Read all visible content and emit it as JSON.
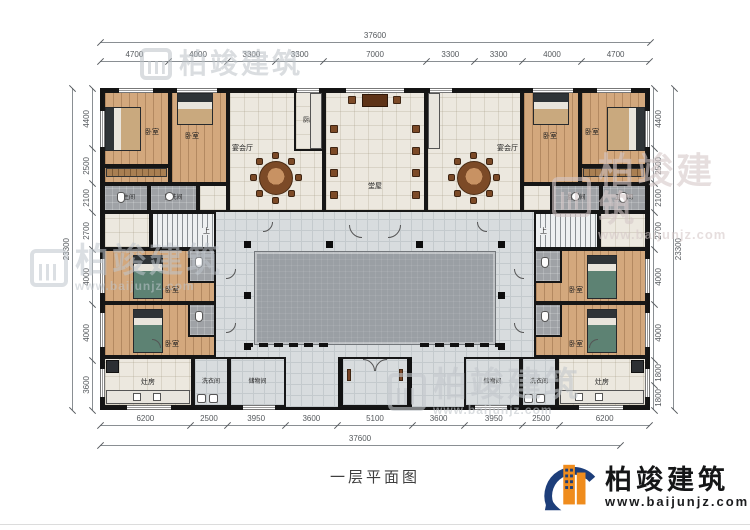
{
  "caption": "一层平面图",
  "logo": {
    "name": "柏竣建筑",
    "url": "www.baijunjz.com"
  },
  "watermark": {
    "brand": "柏竣建筑",
    "url": "www.baijunjz.com"
  },
  "dims": {
    "top_total": [
      "37600"
    ],
    "top_segments": [
      "4700",
      "4000",
      "3300",
      "3300",
      "7000",
      "3300",
      "3300",
      "4000",
      "4700"
    ],
    "bottom_segments": [
      "6200",
      "2500",
      "3950",
      "3600",
      "5100",
      "3600",
      "3950",
      "2500",
      "6200"
    ],
    "bottom_total": [
      "37600"
    ],
    "left_total": [
      "23300"
    ],
    "left_segments": [
      "4400",
      "2500",
      "2100",
      "2700",
      "4000",
      "4000",
      "3600"
    ],
    "right_segments": [
      "4400",
      "2500",
      "2100",
      "2700",
      "4000",
      "4000",
      "1800",
      "1800"
    ],
    "right_total": [
      "23300"
    ]
  },
  "rooms": {
    "bedroom": "卧室",
    "cloakroom": "衣帽间",
    "bathroom": "卫生间",
    "washroom": "盥洗间",
    "banquet_hall": "宴会厅",
    "kitchen": "厨房",
    "main_hall": "堂屋",
    "stove_room": "灶房",
    "laundry": "洗衣间",
    "storage": "储物间",
    "stairs_up": "上"
  },
  "colors": {
    "wall": "#141414",
    "wood_floor": "#d3a87d",
    "tile_floor": "#ece8df",
    "corridor_floor": "#d8dcde",
    "courtyard_floor": "#9a9fa4",
    "bath_floor": "#9fa2a6",
    "logo_blue": "#1d3e7a",
    "logo_orange": "#ef8c1d"
  }
}
